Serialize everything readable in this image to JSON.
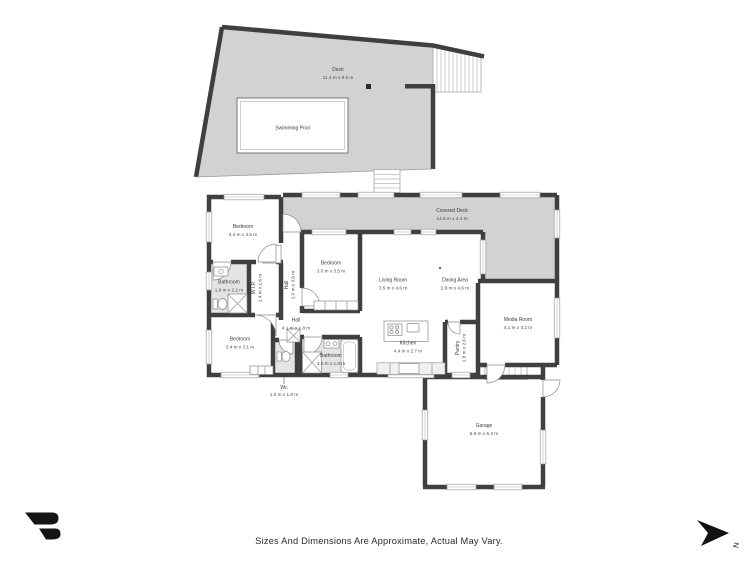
{
  "plan": {
    "rooms": {
      "deck": {
        "name": "Deck",
        "dims": "11.4 m x 9.5 m"
      },
      "swimming_pool": {
        "name": "Swimming Pool"
      },
      "covered_deck": {
        "name": "Covered Deck",
        "dims": "14.6 m x 4.4 m"
      },
      "bedroom_top": {
        "name": "Bedroom",
        "dims": "3.4 m x 3.5 m"
      },
      "bedroom_mid": {
        "name": "Bedroom",
        "dims": "3.0 m x 3.5 m"
      },
      "bedroom_bottom": {
        "name": "Bedroom",
        "dims": "3.4 m x 3.1 m"
      },
      "bathroom_top": {
        "name": "Bathroom",
        "dims": "1.9 m x 2.2 m"
      },
      "bathroom_bottom": {
        "name": "Bathroom",
        "dims": "3.0 m x 1.8 m"
      },
      "wir": {
        "name": "W.I.R",
        "dims": "1.4 m x 1.6 m"
      },
      "hall_vertical": {
        "name": "Hall",
        "dims": "1.0 m x 3.6 m"
      },
      "hall_horizontal": {
        "name": "Hall",
        "dims": "4.1 m x 1.8 m"
      },
      "wc": {
        "name": "Wc",
        "dims": "1.0 m x 1.8 m"
      },
      "living_room": {
        "name": "Living Room",
        "dims": "3.5 m x 4.6 m"
      },
      "dining_area": {
        "name": "Dining Area",
        "dims": "2.8 m x 4.6 m"
      },
      "media_room": {
        "name": "Media Room",
        "dims": "4.1 m x 4.2 m"
      },
      "kitchen": {
        "name": "Kitchen",
        "dims": "4.4 m x 2.7 m"
      },
      "pantry": {
        "name": "Pantry",
        "dims": "1.8 m x 2.6 m"
      },
      "garage": {
        "name": "Garage",
        "dims": "5.9 m x 6.4 m"
      }
    },
    "compass": {
      "label": "N"
    },
    "footer": {
      "disclaimer": "Sizes And Dimensions Are Approximate, Actual May Vary."
    },
    "colors": {
      "wall": "#3f3f3f",
      "deck_fill": "#d2d2d2",
      "bath_floor": "#e4e4e4",
      "text": "#3b3b3b",
      "logo": "#151515"
    }
  }
}
